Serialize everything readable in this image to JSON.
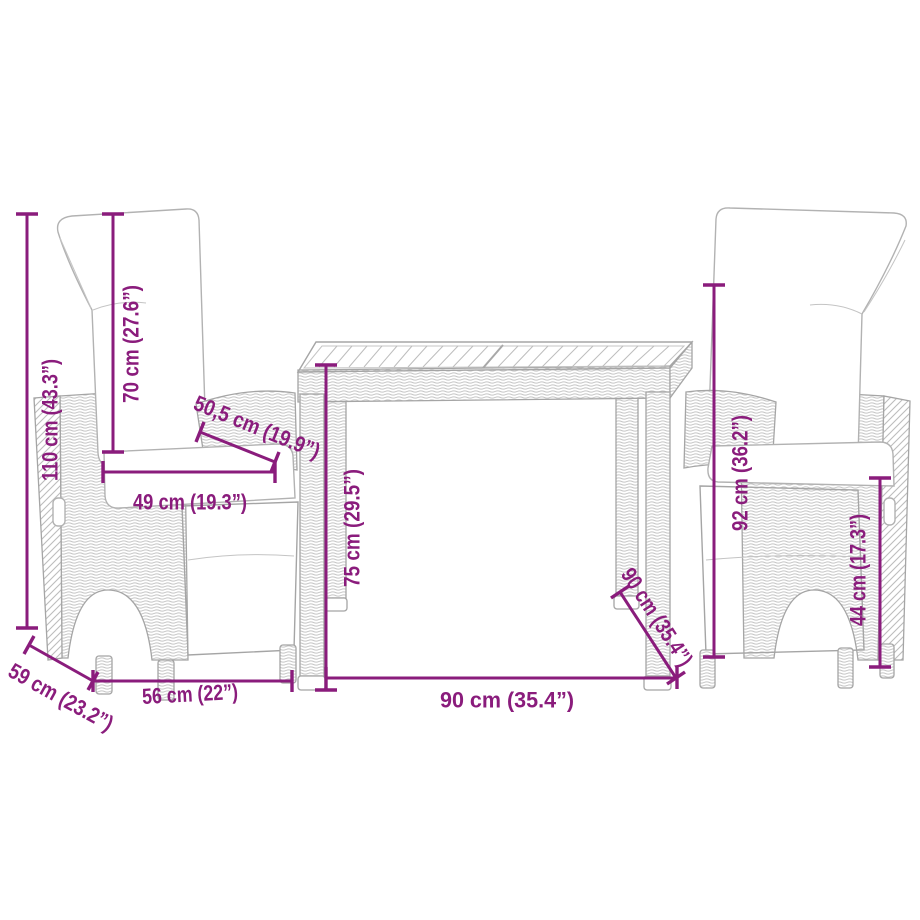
{
  "diagram": {
    "accent_color": "#8A1C7C",
    "furniture_line_color": "#A5A5A5",
    "background": "#FFFFFF"
  },
  "dimensions": {
    "left_chair": {
      "total_height": "110 cm (43.3”)",
      "backrest_height": "70 cm (27.6”)",
      "seat_depth": "50,5 cm (19.9”)",
      "seat_width": "49 cm (19.3”)",
      "base_width": "56 cm (22”)",
      "base_depth": "59 cm (23.2”)"
    },
    "table": {
      "height": "75 cm (29.5”)",
      "width": "90 cm (35.4”)",
      "depth": "90 cm (35.4”)"
    },
    "right_chair": {
      "backrest_height": "92 cm (36.2”)",
      "seat_height": "44 cm (17.3”)"
    }
  }
}
